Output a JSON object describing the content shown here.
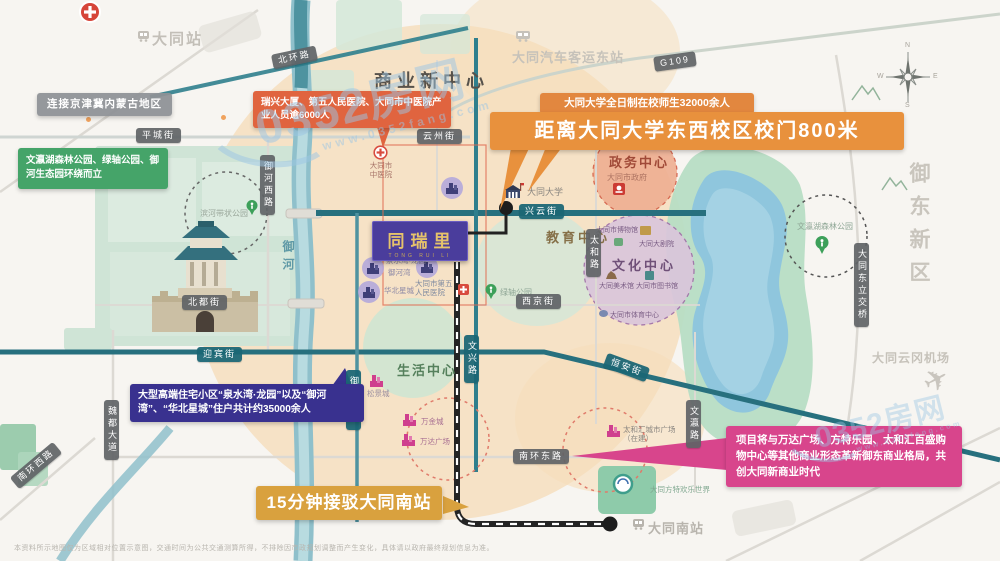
{
  "watermark": {
    "brand": "0352房网",
    "url": "www.0352fang.com"
  },
  "compass": {
    "n": "N",
    "e": "E",
    "s": "S",
    "w": "W"
  },
  "disclaimer": "本资料所示地图仅为区域相对位置示意图，交通时间为公共交通测算所得，不排除因市政规划调整而产生变化，具体请以政府最终规划信息为准。",
  "project": {
    "name": "同瑞里",
    "tagline": "TONG RUI LI"
  },
  "callouts": {
    "region": "连接京津冀内蒙古地区",
    "parks": "文瀛湖森林公园、绿轴公园、御河生态园环绕而立",
    "industry": "瑞兴大厦、第五人民医院、大同市中医院产业人员逾6000人",
    "university_note": "大同大学全日制在校师生32000余人",
    "university_distance": "距离大同大学东西校区校门800米",
    "residential": "大型高端住宅小区“泉水湾·龙园”以及“御河湾”、“华北星城”住户共计约35000余人",
    "south_station": "15分钟接驳大同南站",
    "commerce": "项目将与万达广场、方特乐园、太和汇百盛购物中心等其他商业形态革新御东商业格局，共创大同新商业时代"
  },
  "districts": {
    "business": "商业新中心",
    "yudong": "御东新区",
    "government": "政务中心",
    "government_sub": "大同市政府",
    "education": "教育中心",
    "culture": "文化中心",
    "living": "生活中心",
    "river": "御河"
  },
  "stations": {
    "datong": "大同站",
    "bus_east": "大同汽车客运东站",
    "south": "大同南站",
    "airport": "大同云冈机场"
  },
  "streets": [
    "北环路",
    "G109",
    "平城街",
    "云州街",
    "兴云街",
    "御河西路",
    "北都街",
    "西京街",
    "迎宾街",
    "御河东路",
    "魏都大道",
    "文兴路",
    "太和路",
    "恒安街",
    "南环东路",
    "南环西路",
    "文瀛路",
    "大同东立交桥"
  ],
  "places": [
    "大同大学",
    "大同市中医院",
    "大同市第五人民医院",
    "绿轴公园",
    "文瀛湖森林公园",
    "滨河带状公园",
    "泉水湾·龙园",
    "御河湾",
    "华北星城",
    "松景城",
    "万金城",
    "万达广场",
    "太和汇城市广场（在建）",
    "大同方特欢乐世界",
    "大同市博物馆",
    "大同大剧院",
    "大同美术馆",
    "大同市图书馆",
    "大同市体育中心"
  ]
}
